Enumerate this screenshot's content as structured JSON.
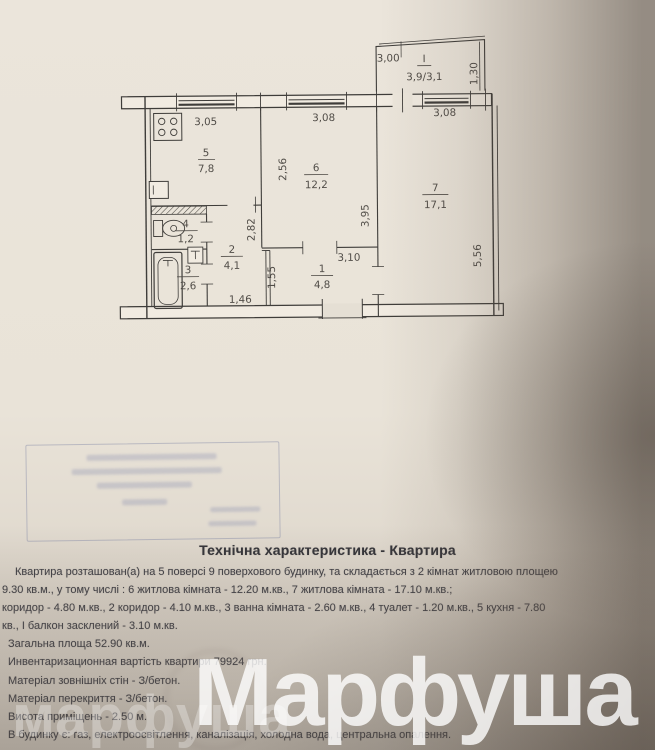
{
  "colors": {
    "paper": "#eae4d9",
    "ink": "#3e3e44",
    "plan_line": "#3f3d3a",
    "stamp_blue": "#767fa8",
    "watermark": "#ffffff"
  },
  "plan": {
    "balcony": {
      "width": "3,00",
      "numeral": "I",
      "area": "3,9/3,1",
      "height": "1,30"
    },
    "top_dims": [
      "3,05",
      "3,08",
      "3,08"
    ],
    "rooms": [
      {
        "num": "5",
        "area": "7,8"
      },
      {
        "num": "6",
        "area": "12,2"
      },
      {
        "num": "7",
        "area": "17,1"
      },
      {
        "num": "4",
        "area": "1,2"
      },
      {
        "num": "2",
        "area": "4,1"
      },
      {
        "num": "3",
        "area": "2,6"
      },
      {
        "num": "1",
        "area": "4,8"
      }
    ],
    "dims": {
      "kitchen_depth": "2,56",
      "room6_depth": "3,95",
      "room7_depth": "5,56",
      "corr2_depth": "2,82",
      "corr1_depth": "1,55",
      "corr1_width": "3,10",
      "corr2_width": "1,46"
    }
  },
  "doc": {
    "title": "Технічна характеристика - Квартира",
    "lines": [
      "Квартира розташован(а) на 5 поверсі 9 поверхового будинку, та складається з 2 кімнат житловою площею",
      "9.30 кв.м., у тому числі : 6 житлова кімната - 12.20 м.кв., 7 житлова кімната - 17.10 м.кв.;",
      "коридор - 4.80 м.кв., 2 коридор - 4.10 м.кв., 3 ванна кімната - 2.60 м.кв., 4 туалет - 1.20 м.кв., 5 кухня - 7.80",
      "кв., І балкон засклений - 3.10 м.кв.",
      "Загальна площа 52.90 кв.м.",
      "Инвентаризационная вартість квартири 79924 грн.",
      "Матеріал зовнішніх стін - З/бетон.",
      "Матеріал перекриття - З/бетон.",
      "Висота приміщень - 2.50 м.",
      "В будинку є: газ, електроосвітлення, каналізація, холодна вода, центральна опалення."
    ]
  },
  "watermark": {
    "large": "Марфуша",
    "small": "марфуша"
  }
}
